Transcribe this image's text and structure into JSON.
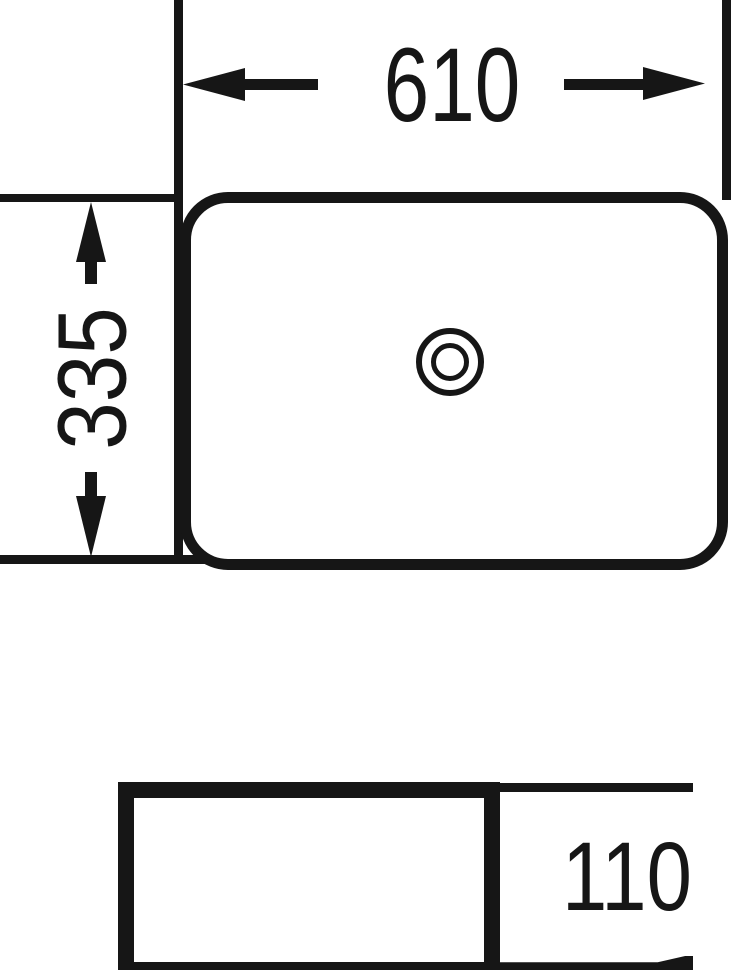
{
  "colors": {
    "line": "#161616",
    "background": "#ffffff"
  },
  "dimensions": {
    "width": "610",
    "depth": "335",
    "height": "110"
  }
}
